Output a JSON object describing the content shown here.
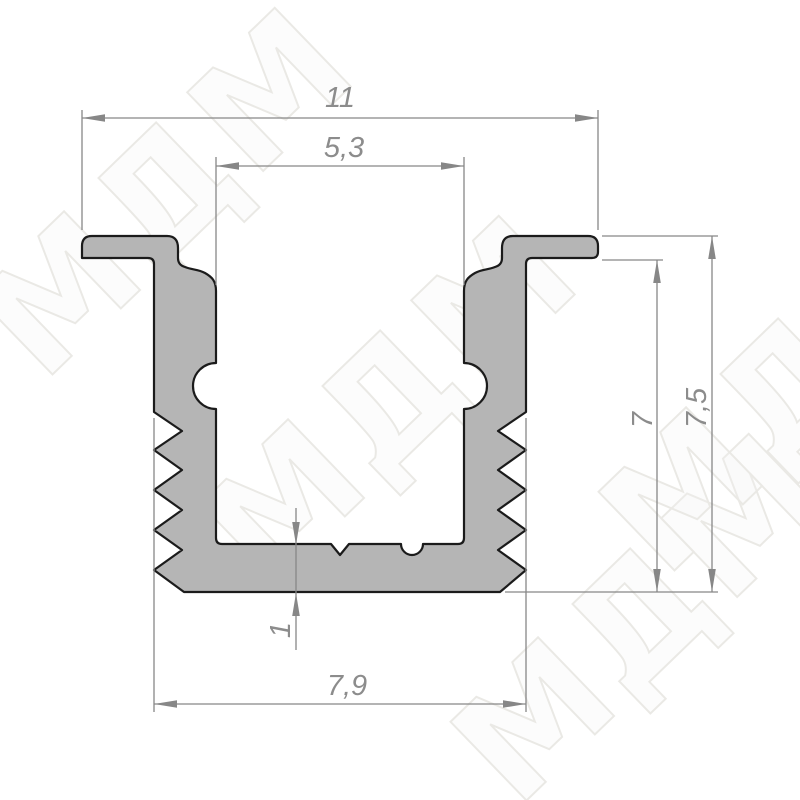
{
  "watermark": {
    "text": "МДМ"
  },
  "colors": {
    "background": "#ffffff",
    "profile_fill": "#b5b5b5",
    "profile_outline": "#1b1b1b",
    "dimension_lines": "#878787",
    "dimension_text": "#8c8c8c",
    "watermark_stroke": "#eae9e5"
  },
  "dimensions": {
    "overall_width": {
      "label": "11"
    },
    "opening_width": {
      "label": "5,3"
    },
    "inner_depth": {
      "label": "7"
    },
    "overall_height": {
      "label": "7,5"
    },
    "bottom_thickness": {
      "label": "1"
    },
    "body_width": {
      "label": "7,9"
    }
  }
}
